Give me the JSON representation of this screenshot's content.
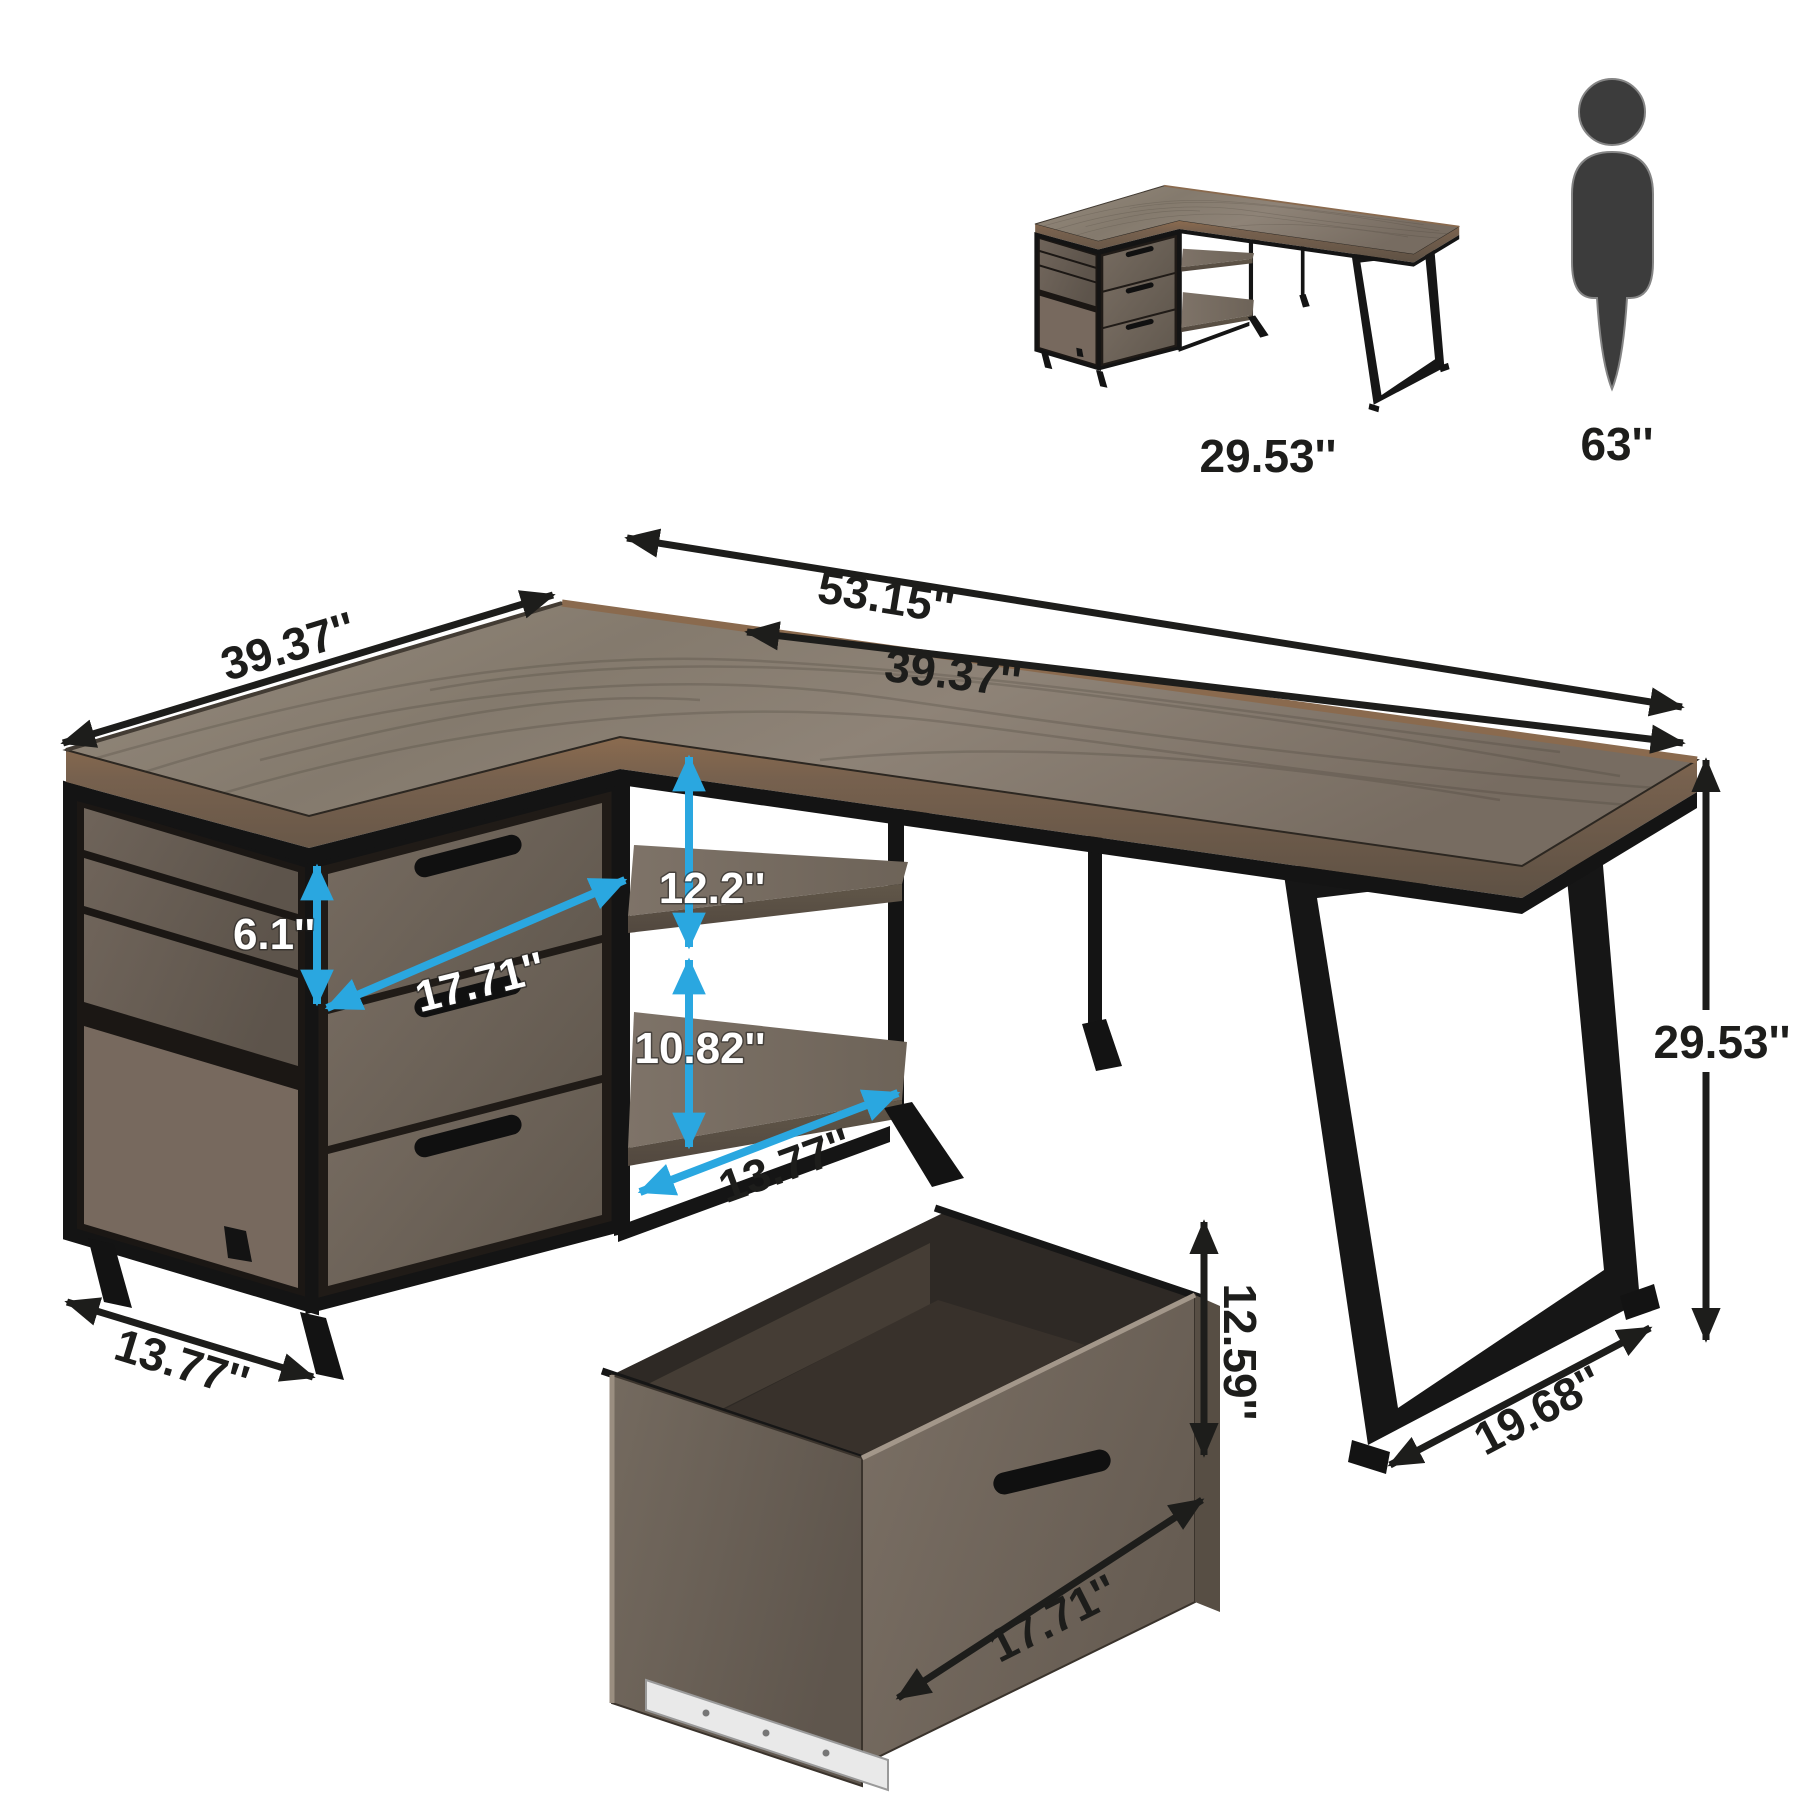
{
  "product_diagram": {
    "thumbnail": {
      "desk_height_label": "29.53''"
    },
    "human": {
      "height_label": "63''"
    },
    "black_dims": {
      "total_width": "53.15''",
      "right_width": "39.37''",
      "left_depth": "39.37''",
      "cabinet_depth": "13.77''",
      "shelf_depth": "13.77''",
      "desk_height": "29.53''",
      "leg_depth": "19.68''",
      "drawer_pullout_height": "12.59''",
      "drawer_pullout_width": "17.71''"
    },
    "blue_dims": {
      "top_drawer_height": "6.1''",
      "drawer_width": "17.71''",
      "upper_shelf_gap": "12.2''",
      "lower_shelf_gap": "10.82''"
    },
    "colors": {
      "accent_blue": "#2aa7e0",
      "arrow_black": "#1d1d1b",
      "wood_top": "#897e72",
      "wood_dark": "#6a5f55",
      "metal": "#161616",
      "figure_gray": "#3c3c3c",
      "background": "#ffffff"
    }
  }
}
